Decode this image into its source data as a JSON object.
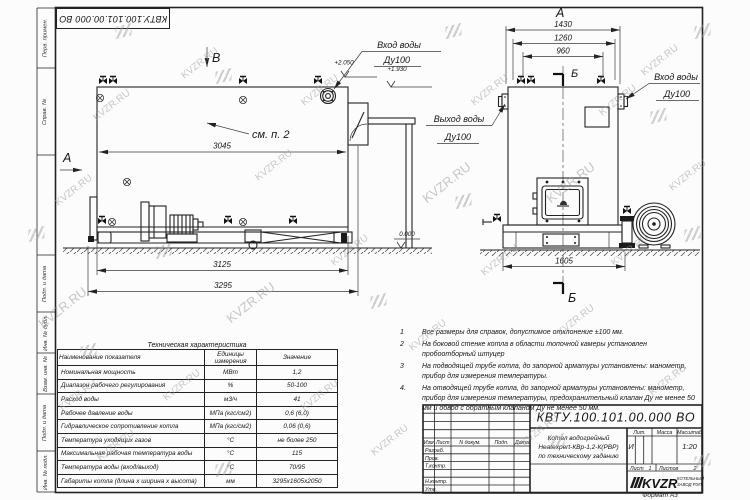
{
  "watermark": "KVZR.RU",
  "margin": {
    "labels": [
      "Перв. примен.",
      "Справ. №",
      "Подп. и дата",
      "Инв. № дубл.",
      "Взам. инв. №",
      "Подп. и дата",
      "Инв. № подл."
    ]
  },
  "views": {
    "side": {
      "view_label": "В",
      "section_label": "А",
      "see_note": "см. п. 2",
      "dim_inner_length": "3045",
      "dim_base_length": "3125",
      "dim_overall_length": "3295",
      "elev_top": "+2.050",
      "elev_inlet": "+1.930",
      "elev_zero": "0.000",
      "inlet_label": "Вход воды",
      "inlet_dn": "Ду100"
    },
    "front": {
      "view_label": "А",
      "section_label": "Б",
      "dim_overall_width": "1430",
      "dim_flange_span": "1260",
      "dim_valve_span": "960",
      "dim_base_width": "1605",
      "outlet_label": "Выход воды",
      "outlet_dn": "Ду100",
      "inlet_label": "Вход воды",
      "inlet_dn": "Ду100"
    }
  },
  "notes": {
    "items": [
      {
        "num": "1",
        "text": "Все размеры для справок, допустимое отклонение ±100 мм."
      },
      {
        "num": "2",
        "text": "На боковой стенке котла в области топочной камеры установлен пробоотборный штуцер"
      },
      {
        "num": "3",
        "text": "На подводящей трубе котла, до запорной арматуры установлены: манометр, прибор для измерения температуры."
      },
      {
        "num": "4.",
        "text": "На отводящей трубе котла, до запорной арматуры установлены: манометр, прибор для измерения температуры, предохранительный клапан Ду не менее 50 мм и обвод с обратным клапаном Ду не менее 50 мм."
      }
    ]
  },
  "tech_table": {
    "title": "Техническая характеристика",
    "headers": [
      "Наименование показателя",
      "Единицы измерения",
      "Значение"
    ],
    "rows": [
      [
        "Номинальная мощность",
        "МВт",
        "1,2"
      ],
      [
        "Диапазон рабочего регулирования",
        "%",
        "50-100"
      ],
      [
        "Расход воды",
        "м3/ч",
        "41"
      ],
      [
        "Рабочее давление воды",
        "МПа (кгс/см2)",
        "0,6 (6,0)"
      ],
      [
        "Гидравлическое сопротивление котла",
        "МПа (кгс/см2)",
        "0,06 (0,6)"
      ],
      [
        "Температура уходящих газов",
        "°С",
        "не более 250"
      ],
      [
        "Максимальная рабочая температура воды",
        "°С",
        "115"
      ],
      [
        "Температура воды (вход/выход)",
        "°С",
        "70/95"
      ],
      [
        "Габариты котла (длина х ширина х высота)",
        "мм",
        "3295х1605х2050"
      ]
    ]
  },
  "title_block": {
    "designation": "КВТУ.100.101.00.000  ВО",
    "col_izm": "Изм",
    "col_list": "Лист",
    "col_doc": "N докум.",
    "col_sign": "Подп.",
    "col_date": "Дата",
    "role_developed": "Разраб.",
    "role_checked": "Пров.",
    "role_tcontrol": "Т.контр.",
    "role_ncontrol": "Н.контр.",
    "role_approved": "Утв.",
    "product_name_line1": "Котел водогрейный",
    "product_name_line2": "Heatexpert-КВр-1,2-К(РВР)",
    "product_name_line3": "по техническому заданию",
    "lit_label": "Лит.",
    "mass_label": "Масса",
    "scale_label": "Масштаб",
    "lit_value": "И",
    "scale_value": "1:20",
    "sheet_label": "Лист",
    "sheet_value": "1",
    "sheets_label": "Листов",
    "sheets_value": "2",
    "company_name": "KVZR",
    "company_sub1": "КОТЕЛЬНЫЙ",
    "company_sub2": "ЗАВОД РЭП",
    "format_label": "Формат  А3"
  }
}
